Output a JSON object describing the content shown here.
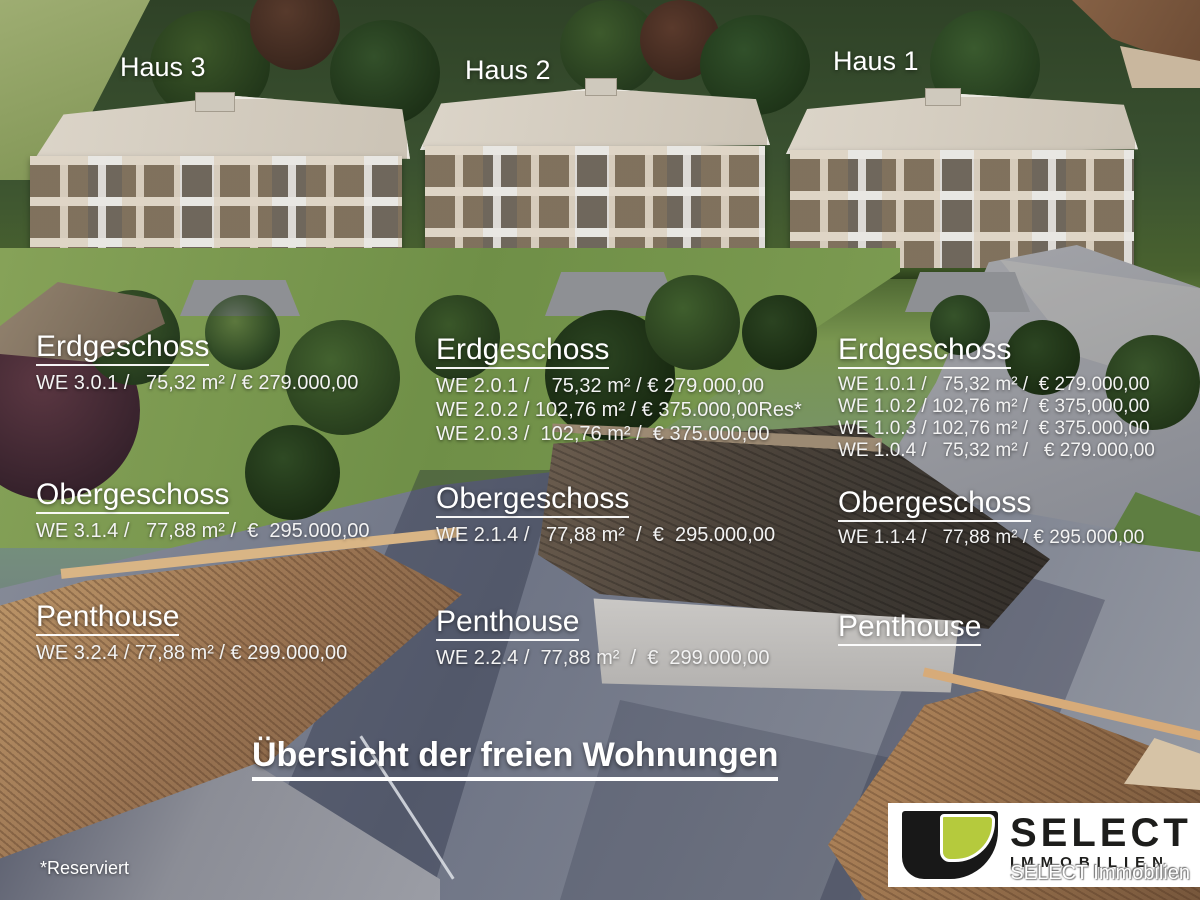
{
  "page": {
    "title": "Übersicht der freien Wohnungen",
    "footnote": "*Reserviert"
  },
  "houses": [
    {
      "label": "Haus 3",
      "sections": [
        {
          "heading": "Erdgeschoss",
          "units": [
            "WE 3.0.1 /   75,32 m² / € 279.000,00"
          ]
        },
        {
          "heading": "Obergeschoss",
          "units": [
            "WE 3.1.4 /   77,88 m² /  €  295.000,00"
          ]
        },
        {
          "heading": "Penthouse",
          "units": [
            "WE 3.2.4 / 77,88 m² / € 299.000,00"
          ]
        }
      ]
    },
    {
      "label": "Haus 2",
      "sections": [
        {
          "heading": "Erdgeschoss",
          "units": [
            "WE 2.0.1 /    75,32 m² / € 279.000,00",
            "WE 2.0.2 / 102,76 m² / € 375.000,00Res*",
            "WE 2.0.3 /  102,76 m² /  € 375.000,00"
          ]
        },
        {
          "heading": "Obergeschoss",
          "units": [
            "WE 2.1.4 /   77,88 m²  /  €  295.000,00"
          ]
        },
        {
          "heading": "Penthouse",
          "units": [
            "WE 2.2.4 /  77,88 m²  /  €  299.000,00"
          ]
        }
      ]
    },
    {
      "label": "Haus 1",
      "sections": [
        {
          "heading": "Erdgeschoss",
          "units": [
            "WE 1.0.1 /   75,32 m² /  € 279.000,00",
            "WE 1.0.2 / 102,76 m² /  € 375,000,00",
            "WE 1.0.3 / 102,76 m² /  € 375.000,00",
            "WE 1.0.4 /   75,32 m² /   € 279.000,00"
          ]
        },
        {
          "heading": "Obergeschoss",
          "units": [
            "WE 1.1.4 /   77,88 m² / € 295.000,00"
          ]
        },
        {
          "heading": "Penthouse",
          "units": []
        }
      ]
    }
  ],
  "logo": {
    "brand": "SELECT",
    "subtitle": "IMMOBILIEN",
    "caption": "SELECT Immobilien",
    "accent_green": "#b5ca3d",
    "brand_black": "#1d1d1b"
  }
}
